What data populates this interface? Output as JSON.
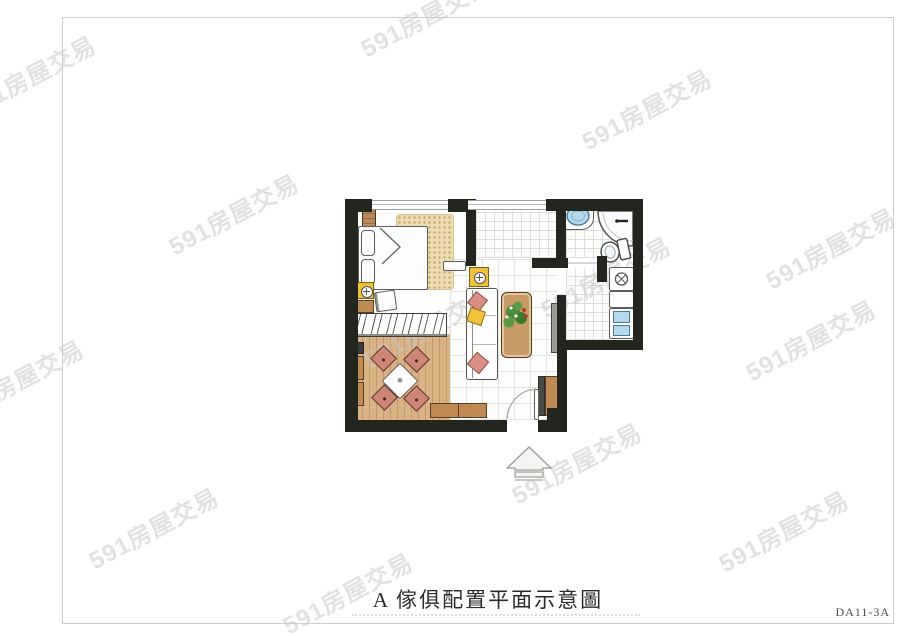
{
  "caption": {
    "label": "A 傢俱配置平面示意圖",
    "code": "DA11-3A"
  },
  "watermark": {
    "text": "591房屋交易",
    "color": "#cbc9c7",
    "rotation_deg": -28,
    "positions": [
      [
        30,
        75
      ],
      [
        233,
        213
      ],
      [
        425,
        15
      ],
      [
        646,
        108
      ],
      [
        830,
        247
      ],
      [
        428,
        326
      ],
      [
        605,
        276
      ],
      [
        18,
        379
      ],
      [
        153,
        527
      ],
      [
        347,
        592
      ],
      [
        576,
        462
      ],
      [
        783,
        530
      ],
      [
        810,
        339
      ]
    ]
  },
  "plan": {
    "furniture": [
      "double-bed",
      "pillows",
      "area-rug",
      "bedside-lamp-table",
      "dresser",
      "desk-chair",
      "wardrobe-with-hangers",
      "dining-table",
      "dining-chairs",
      "sideboard",
      "wall-shelves",
      "sofa",
      "throw-pillows",
      "sofa-end-table",
      "coffee-table",
      "potted-plant",
      "tv-panel",
      "shoe-cabinet",
      "entry-door",
      "bathroom-sink",
      "shower",
      "toilet",
      "kitchen-stove",
      "kitchen-sink",
      "entrance-arrow"
    ],
    "colors": {
      "wall": "#23261f",
      "wood": "#c39a66",
      "chair": "#cf8576",
      "accent_yellow": "#f0c23c",
      "water_blue": "#b5d9ec",
      "rug": "#ecdcb4"
    }
  }
}
